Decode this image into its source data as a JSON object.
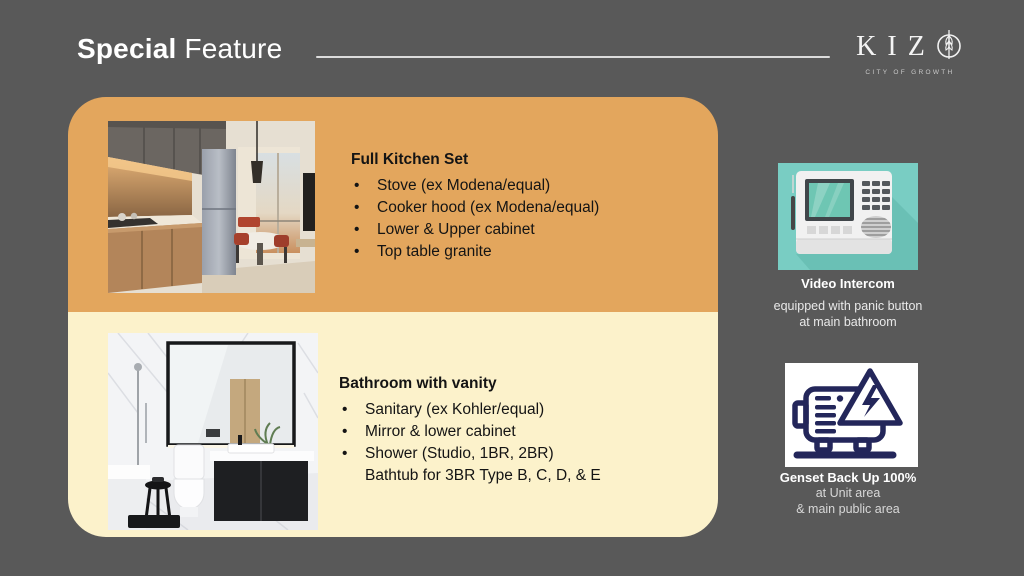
{
  "slide": {
    "background_color": "#595959",
    "card_top_color": "#E3A65D",
    "card_bottom_color": "#FCF2CB"
  },
  "header": {
    "title_bold": "Special",
    "title_regular": " Feature"
  },
  "logo": {
    "letters": "KIZ",
    "o_icon": "wheat-in-circle",
    "tagline": "CITY OF GROWTH"
  },
  "card": {
    "kitchen": {
      "heading": "Full Kitchen Set",
      "bullets": [
        "Stove (ex Modena/equal)",
        "Cooker hood (ex Modena/equal)",
        "Lower & Upper cabinet",
        "Top table granite"
      ]
    },
    "bathroom": {
      "heading": "Bathroom with vanity",
      "bullets": [
        "Sanitary (ex Kohler/equal)",
        "Mirror & lower cabinet",
        "Shower (Studio, 1BR, 2BR)"
      ],
      "continuation": "Bathtub for 3BR Type B, C, D, & E"
    }
  },
  "sidebar": {
    "intercom": {
      "panel_color": "#79CDC3",
      "title": "Video Intercom",
      "desc_line1": "equipped with panic button",
      "desc_line2": "at main bathroom"
    },
    "genset": {
      "panel_color": "#FFFFFF",
      "icon_color": "#23265A",
      "title": "Genset Back Up 100%",
      "desc_line1": "at Unit area",
      "desc_line2": "& main public area"
    }
  }
}
